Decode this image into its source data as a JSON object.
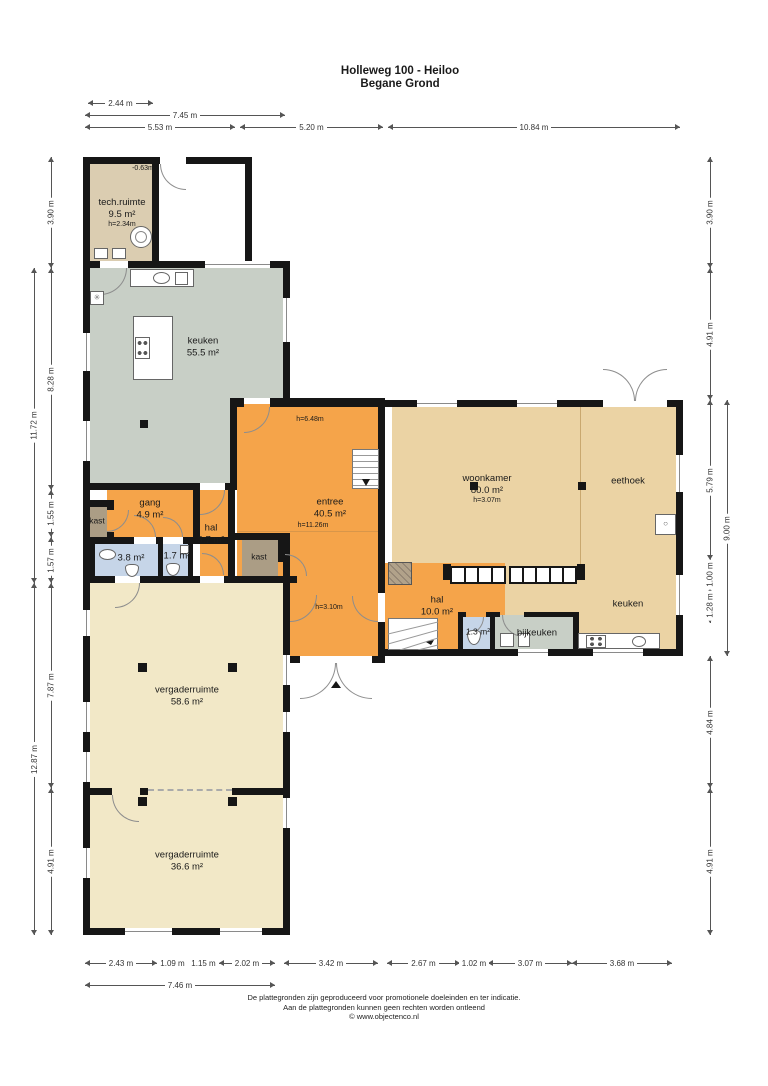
{
  "title": {
    "line1": "Holleweg 100 - Heiloo",
    "line2": "Begane Grond"
  },
  "rooms": {
    "techruimte": {
      "name": "tech.ruimte",
      "area": "9.5 m²",
      "height": "h=2.34m"
    },
    "keuken": {
      "name": "keuken",
      "area": "55.5 m²"
    },
    "gang": {
      "name": "gang",
      "area": "4.9 m²"
    },
    "kast_links": {
      "name": "kast"
    },
    "badkamer": {
      "area": "3.8 m²"
    },
    "wc": {
      "area": "1.7 m²"
    },
    "hal": {
      "name": "hal",
      "area": "3.7 m²"
    },
    "kast_rechts": {
      "name": "kast"
    },
    "entree": {
      "name": "entree",
      "area": "40.5 m²"
    },
    "woonkamer": {
      "name": "woonkamer",
      "area": "80.0 m²",
      "height": "h=3.07m"
    },
    "eethoek": {
      "name": "eethoek"
    },
    "keuken_rechts": {
      "name": "keuken"
    },
    "hal2": {
      "name": "hal",
      "area": "10.0 m²"
    },
    "wc2": {
      "area": "1.3 m²"
    },
    "bijkeuken": {
      "name": "bijkeuken"
    },
    "vergaderruimte1": {
      "name": "vergaderruimte",
      "area": "58.6 m²"
    },
    "vergaderruimte2": {
      "name": "vergaderruimte",
      "area": "36.6 m²"
    }
  },
  "annotations": {
    "level_offset": "-0.63m",
    "h_entree_top": "h=6.48m",
    "h_entree_mid": "h=11.26m",
    "h_entree_low": "h=3.10m"
  },
  "dimensions": {
    "top": [
      "2.44 m",
      "7.45 m",
      "5.53 m",
      "5.20 m",
      "10.84 m"
    ],
    "left": [
      "3.90 m",
      "8.28 m",
      "11.72 m",
      "1.55 m",
      "1.57 m",
      "7.87 m",
      "12.87 m",
      "4.91 m"
    ],
    "right": [
      "3.90 m",
      "4.91 m",
      "5.79 m",
      "9.00 m",
      "1.00 m",
      "1.28 m",
      "4.84 m",
      "4.91 m"
    ],
    "bottom": [
      "2.43 m",
      "1.09 m",
      "1.15 m",
      "2.02 m",
      "3.42 m",
      "2.67 m",
      "1.02 m",
      "3.07 m",
      "3.68 m",
      "7.46 m"
    ]
  },
  "footer": {
    "line1": "De plattegronden zijn geproduceerd voor promotionele doeleinden en ter indicatie.",
    "line2": "Aan de plattegronden kunnen geen rechten worden ontleend",
    "line3": "© www.objectenco.nl"
  },
  "colors": {
    "wall": "#161616",
    "tan_room": "#ebd3a4",
    "tech_tan": "#dbcdb1",
    "sage_green": "#c8cfc6",
    "orange": "#f5a44a",
    "cream": "#f2e8c7",
    "light_blue": "#c6d5e8",
    "closet_brown": "#ab9d85"
  }
}
